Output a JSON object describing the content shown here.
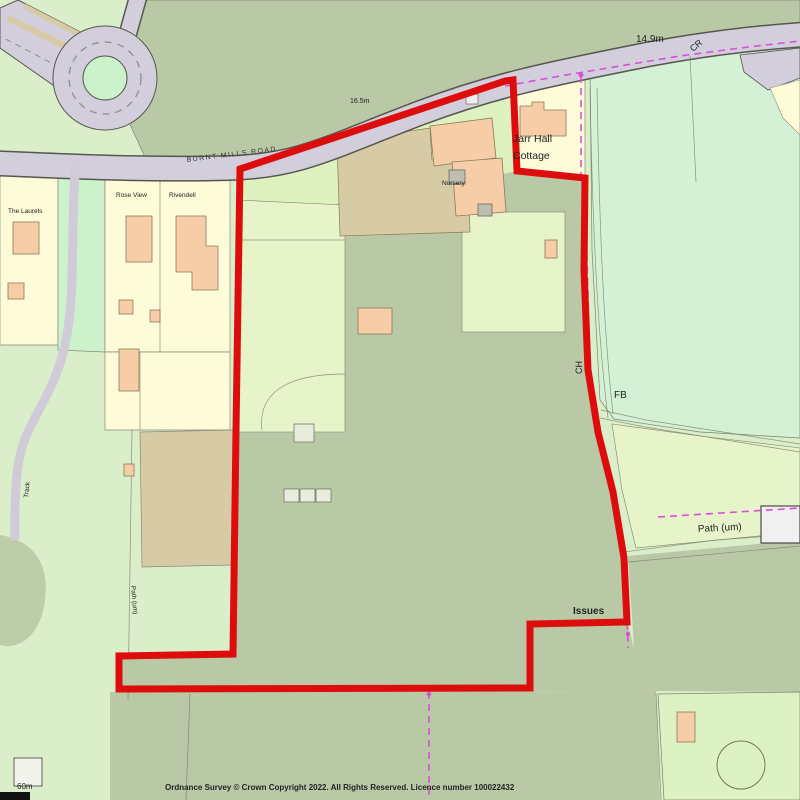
{
  "map": {
    "road_label": "BURNT MILLS ROAD",
    "spot_heights": {
      "east": "14.9m",
      "mid": "16.5m"
    },
    "boundary_labels": {
      "cr": "CR",
      "ch": "CH"
    },
    "properties": {
      "cottage_line1": "Jarr Hall",
      "cottage_line2": "Cottage",
      "nursery": "Nursery",
      "house_left": "The Laurels",
      "house_mid": "Rose View",
      "house_right": "Rivendell"
    },
    "features": {
      "footbridge": "FB",
      "path_right": "Path (um)",
      "path_left": "Path (um)",
      "track": "Track",
      "issues": "Issues"
    }
  },
  "footer": {
    "copyright": "Ordnance Survey © Crown Copyright 2022. All Rights Reserved. Licence number 100022432",
    "scale_label": "60m"
  },
  "colors": {
    "site_boundary_red": "#dd0d0d",
    "parish_magenta": "#d94fd9",
    "water_label_blue": "#2e9fd4",
    "road_fill": "#d2cedb",
    "field_sage": "#b9c9a5",
    "grass_light": "#daeeca",
    "parcel_cream": "#fdfbd8",
    "building_peach": "#f6cda6",
    "nursery_tan": "#d6cba4",
    "mint_field": "#d4f1d6"
  }
}
